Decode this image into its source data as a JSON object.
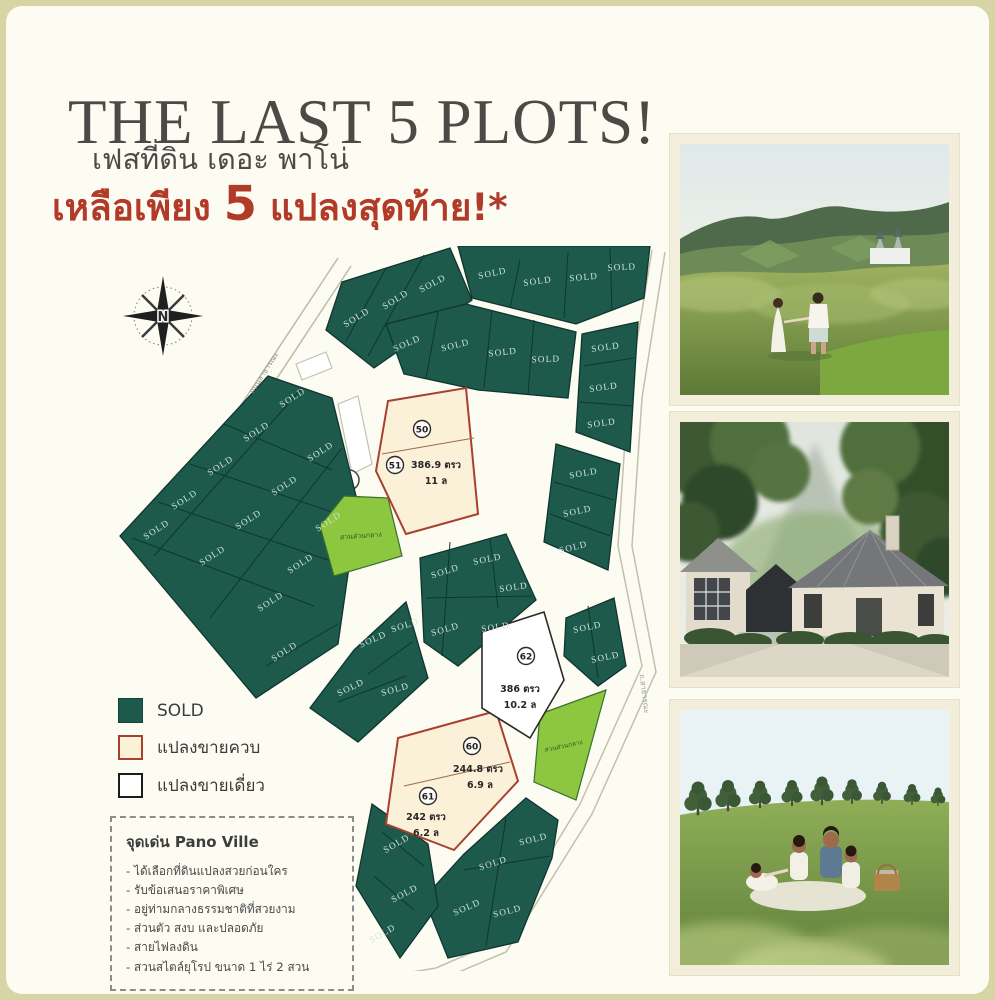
{
  "header": {
    "title": "THE LAST 5 PLOTS!",
    "subtitle": "เฟสที่ดิน เดอะ พาโน่",
    "promo": {
      "prefix": "เหลือเพียง ",
      "number": "5",
      "suffix": " แปลงสุดท้าย!*"
    }
  },
  "map": {
    "compass": "N",
    "sold_label": "SOLD",
    "park_label": "สวนส่วนกลาง",
    "road_left": "ถนนสาธารณะ",
    "road_right": "ถ.สาธารณะ",
    "plots": [
      {
        "no": "50",
        "area": "386.9 ตรว",
        "price": "11 ล"
      },
      {
        "no": "51",
        "area": "",
        "price": ""
      },
      {
        "no": "62",
        "area": "386 ตรว",
        "price": "10.2 ล"
      },
      {
        "no": "60",
        "area": "244.8 ตรว",
        "price": "6.9 ล"
      },
      {
        "no": "61",
        "area": "242 ตรว",
        "price": "6.2 ล"
      }
    ]
  },
  "legend": [
    {
      "type": "sold",
      "label": "SOLD"
    },
    {
      "type": "bundle",
      "label": "แปลงขายควบ"
    },
    {
      "type": "single",
      "label": "แปลงขายเดี่ยว"
    }
  ],
  "features": {
    "title": "จุดเด่น Pano Ville",
    "items": [
      "ได้เลือกที่ดินแปลงสวยก่อนใคร",
      "รับข้อเสนอราคาพิเศษ",
      "อยู่ท่ามกลางธรรมชาติที่สวยงาม",
      "ส่วนตัว สงบ และปลอดภัย",
      "สายไฟลงดิน",
      "สวนสไตล์ยุโรป ขนาด 1 ไร่ 2 สวน"
    ]
  },
  "colors": {
    "sold": "#1d5a4b",
    "park": "#8dc63f",
    "bundle_fill": "#fbf1d9",
    "bundle_border": "#a8402f",
    "accent_red": "#b23a28",
    "title_gray": "#4b4a47"
  }
}
